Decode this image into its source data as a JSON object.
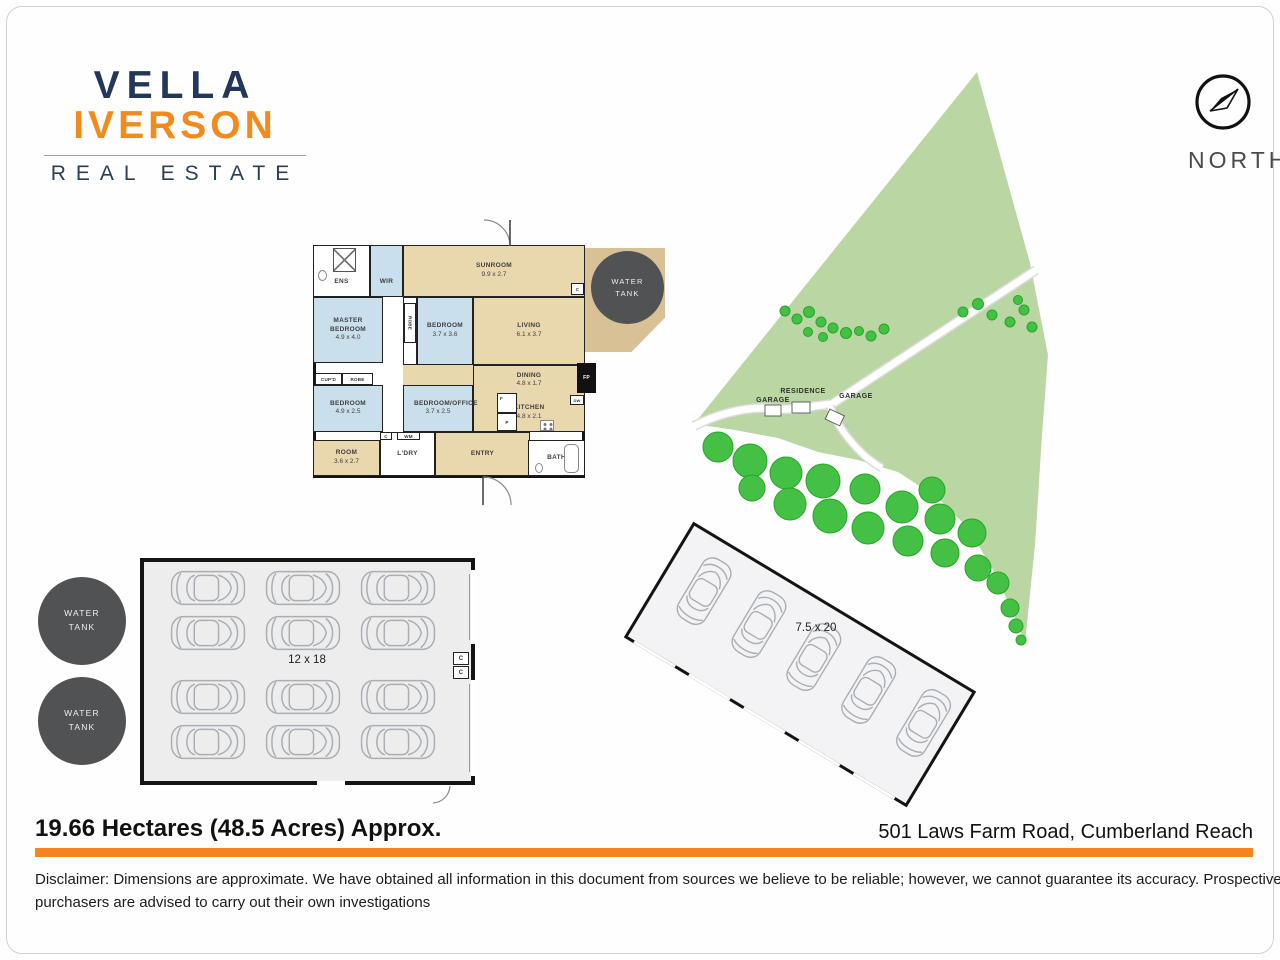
{
  "logo": {
    "name_top": "VELLA",
    "name_bottom": "IVERSON",
    "tagline": "REAL ESTATE",
    "navy_color": "#22375a",
    "orange_color": "#f28a1c"
  },
  "compass": {
    "label": "NORTH"
  },
  "floorplan": {
    "rooms": [
      {
        "name": "ENS",
        "dims": ""
      },
      {
        "name": "WIR",
        "dims": ""
      },
      {
        "name": "SUNROOM",
        "dims": "9.9 x 2.7"
      },
      {
        "name": "MASTER BEDROOM",
        "dims": "4.9 x 4.0"
      },
      {
        "name": "BEDROOM",
        "dims": "3.7 x 3.6"
      },
      {
        "name": "LIVING",
        "dims": "6.1 x 3.7"
      },
      {
        "name": "DINING",
        "dims": "4.8 x 1.7"
      },
      {
        "name": "KITCHEN",
        "dims": "4.8 x 2.1"
      },
      {
        "name": "BEDROOM",
        "dims": "4.9 x 2.5"
      },
      {
        "name": "BEDROOM/OFFICE",
        "dims": "3.7 x 2.5"
      },
      {
        "name": "ROOM",
        "dims": "3.6 x 2.7"
      },
      {
        "name": "L'DRY",
        "dims": ""
      },
      {
        "name": "ENTRY",
        "dims": ""
      },
      {
        "name": "BATH",
        "dims": ""
      }
    ],
    "fixtures": {
      "robe_vertical": "ROBE",
      "cupd": "CUP'D",
      "robe": "ROBE",
      "cupboard_laundry": "C",
      "washing_machine": "WM",
      "fridge": "F",
      "pantry": "P",
      "fireplace": "FP",
      "dishwasher": "DW",
      "cupboard_living": "C"
    },
    "water_tank": {
      "line1": "WATER",
      "line2": "TANK"
    },
    "bedroom_color": "#cadfec",
    "living_color": "#e9d7ad"
  },
  "site_map": {
    "labels": [
      "GARAGE",
      "RESIDENCE",
      "GARAGE"
    ],
    "land_color": "#b9d6a3",
    "tree_color": "#44c144"
  },
  "shed": {
    "dims_label": "12 x 18",
    "cupboards": [
      "C",
      "C"
    ],
    "car_count": 12
  },
  "carport": {
    "dims_label": "7.5 x 20",
    "car_count": 5
  },
  "water_tanks": [
    {
      "line1": "WATER",
      "line2": "TANK"
    },
    {
      "line1": "WATER",
      "line2": "TANK"
    }
  ],
  "footer": {
    "area": "19.66 Hectares (48.5 Acres) Approx.",
    "address": "501 Laws Farm Road, Cumberland Reach",
    "accent_color": "#f5831f",
    "disclaimer_line1": "Disclaimer: Dimensions are approximate. We have obtained all information in this document from sources we believe to be reliable; however, we cannot guarantee its accuracy. Prospective",
    "disclaimer_line2": "purchasers are advised to carry out their own investigations"
  }
}
